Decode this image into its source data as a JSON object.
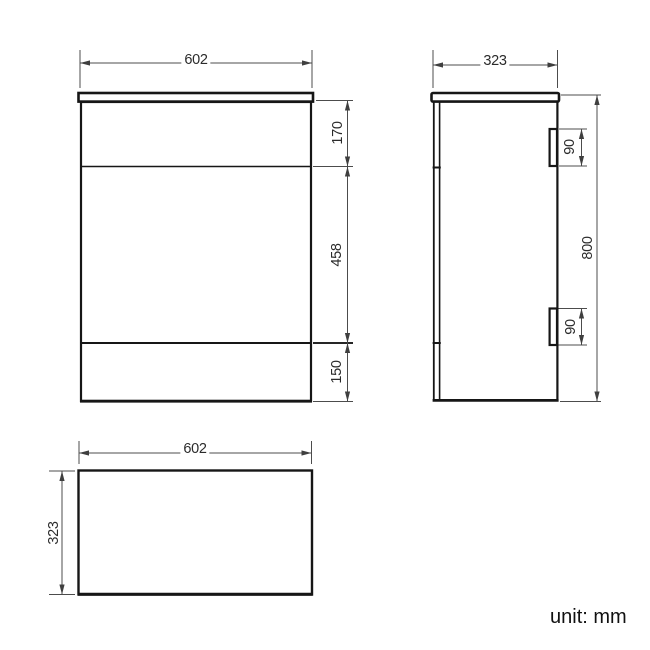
{
  "unit_note": "unit: mm",
  "colors": {
    "object_line": "#161616",
    "dimension_line": "#4c4c4c",
    "background": "#ffffff"
  },
  "drawing": {
    "front_view": {
      "width": "602",
      "sections": {
        "drawer_height": "170",
        "door_height": "458",
        "plinth_height": "150"
      }
    },
    "side_view": {
      "depth": "323",
      "height": "800",
      "hinge_top_height": "90",
      "hinge_bottom_height": "90"
    },
    "top_view": {
      "width": "602",
      "depth": "323"
    }
  }
}
